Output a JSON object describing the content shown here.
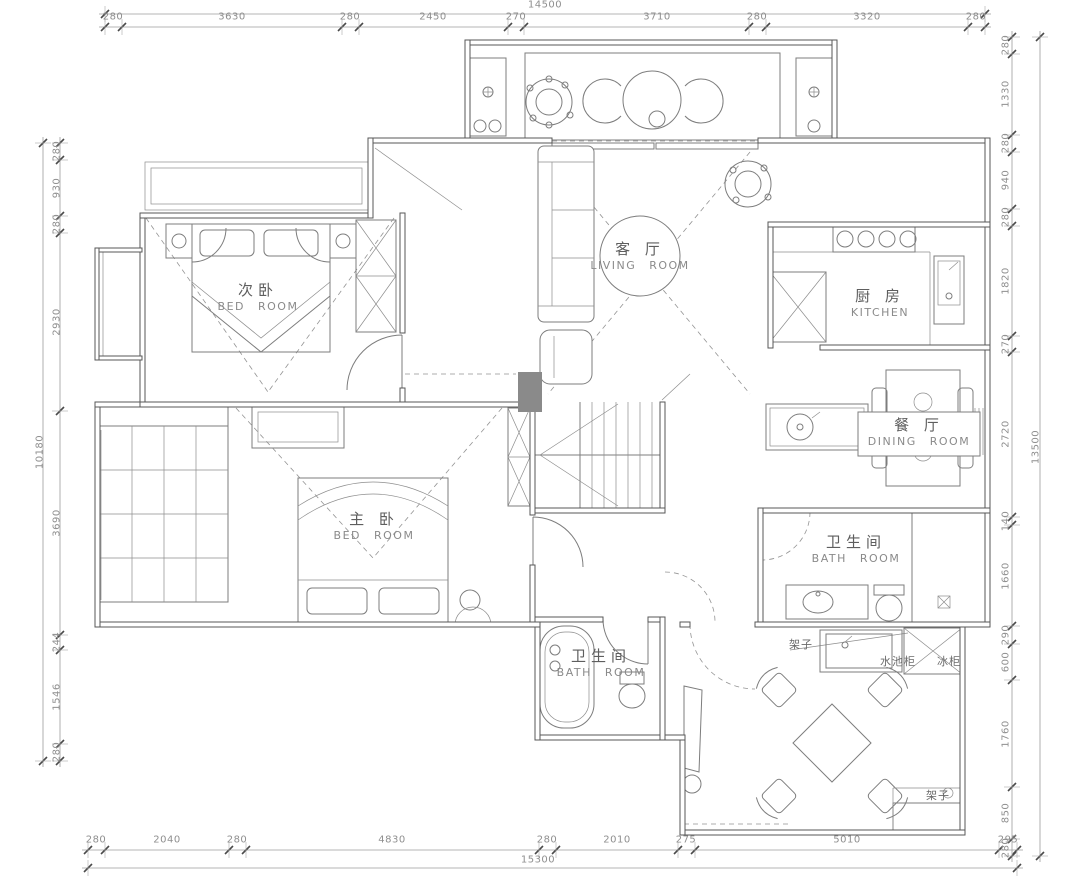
{
  "rooms": [
    {
      "id": "bedroom-secondary",
      "zh": "次卧",
      "en": "BED ROOM"
    },
    {
      "id": "living-room",
      "zh": "客 厅",
      "en": "LIVING ROOM"
    },
    {
      "id": "kitchen",
      "zh": "厨 房",
      "en": "KITCHEN"
    },
    {
      "id": "dining-room",
      "zh": "餐 厅",
      "en": "DINING ROOM"
    },
    {
      "id": "bathroom-right",
      "zh": "卫生间",
      "en": "BATH ROOM"
    },
    {
      "id": "bedroom-master",
      "zh": "主 卧",
      "en": "BED ROOM"
    },
    {
      "id": "bathroom-lower",
      "zh": "卫生间",
      "en": "BATH ROOM"
    }
  ],
  "annotations": [
    {
      "id": "shelf-top",
      "text": "架子"
    },
    {
      "id": "sink-cabinet",
      "text": "水池柜"
    },
    {
      "id": "freezer-cabinet",
      "text": "冰柜"
    },
    {
      "id": "shelf-bottom",
      "text": "架子"
    }
  ],
  "dimensions": {
    "top": {
      "total": "14500",
      "segments": [
        "280",
        "3630",
        "280",
        "2450",
        "270",
        "3710",
        "280",
        "3320",
        "280"
      ]
    },
    "bottom": {
      "total": "15300",
      "segments": [
        "280",
        "2040",
        "280",
        "4830",
        "280",
        "2010",
        "275",
        "5010",
        "295"
      ]
    },
    "left": {
      "total": "10180",
      "segments": [
        "280",
        "930",
        "280",
        "2930",
        "3690",
        "244",
        "1546",
        "280"
      ]
    },
    "right": {
      "total": "13500",
      "segments": [
        "280",
        "1330",
        "280",
        "940",
        "280",
        "1820",
        "270",
        "2720",
        "140",
        "1660",
        "290",
        "600",
        "1760",
        "850",
        "280"
      ]
    }
  },
  "colors": {
    "wall_line": "#575757",
    "furniture_line": "#7d7d7d",
    "dimension_text": "#8f8f8f",
    "label_zh": "#5e5e5e",
    "label_en": "#8a8a8a",
    "column_fill": "#8a8a8a",
    "background": "#ffffff"
  }
}
